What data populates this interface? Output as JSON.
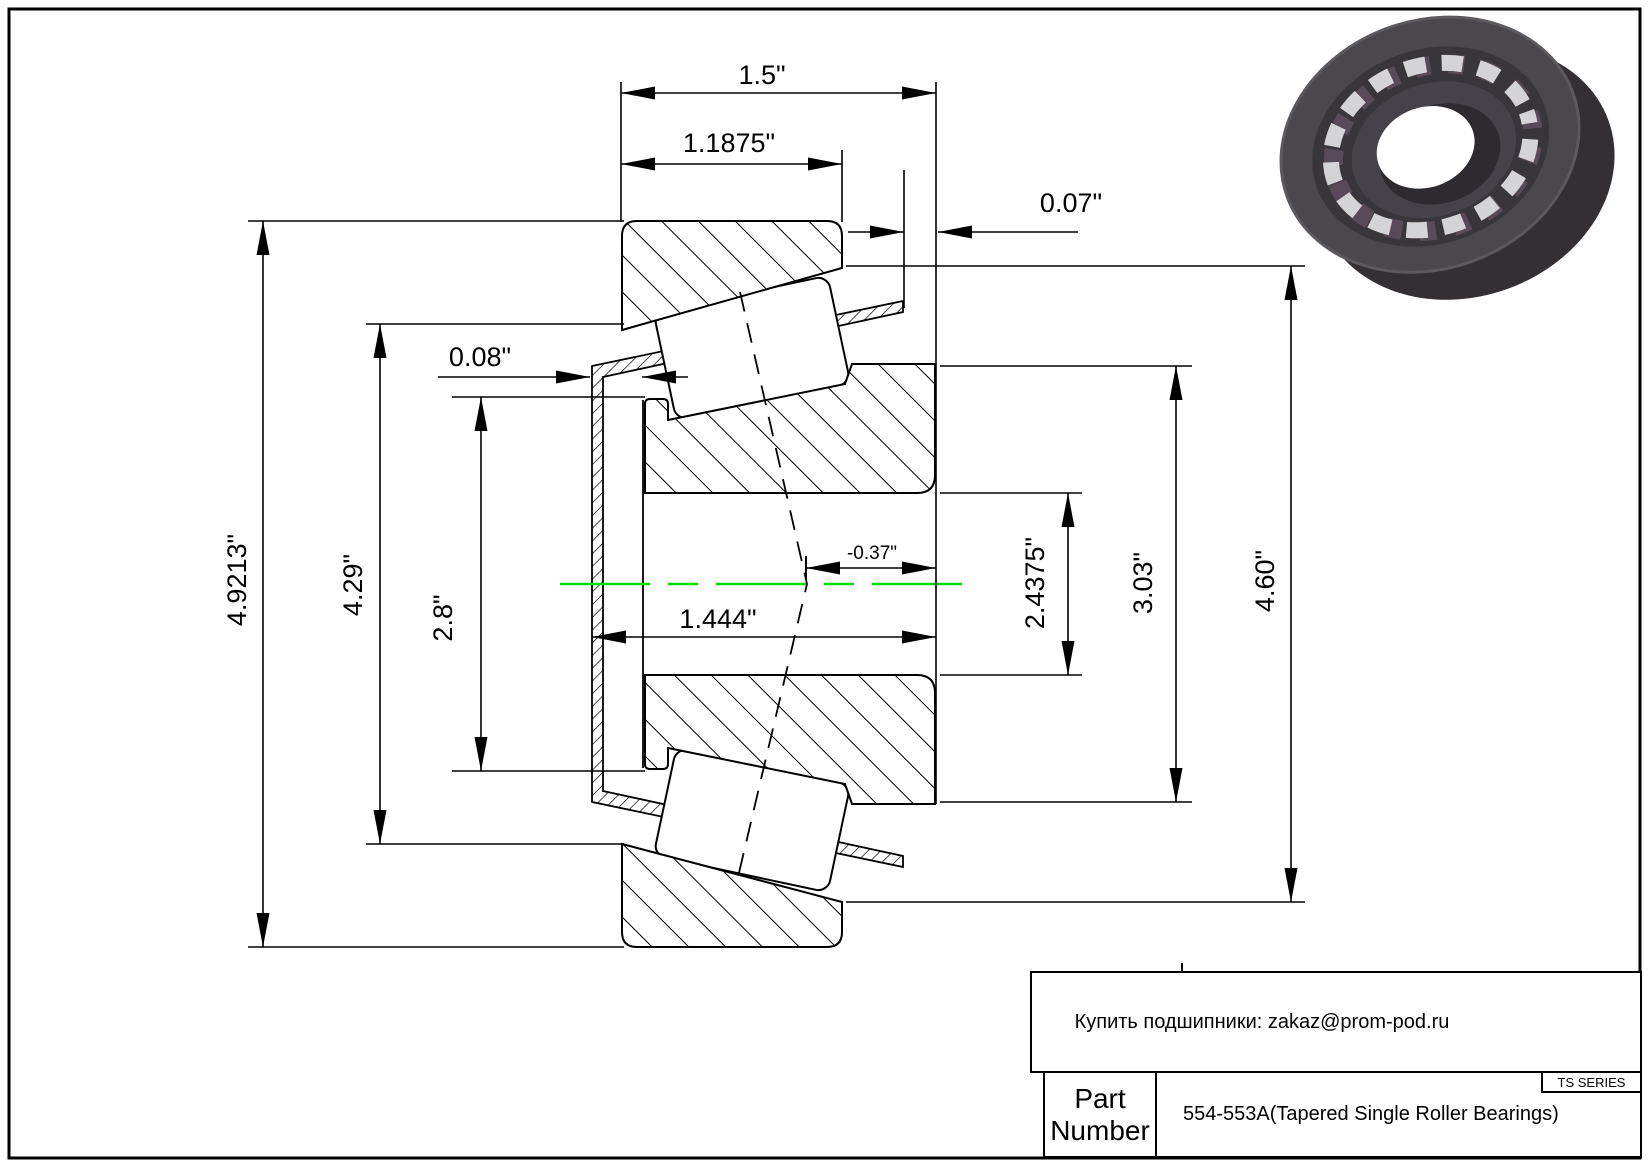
{
  "dims": {
    "overall_width": "1.5\"",
    "cup_width": "1.1875\"",
    "right_standout": "0.07\"",
    "left_standout": "0.08\"",
    "effective_center": "-0.37\"",
    "cone_width": "1.444\"",
    "outer_diameter": "4.9213\"",
    "flange_diameter": "4.29\"",
    "rib_diameter": "2.8\"",
    "bore_diameter": "2.4375\"",
    "cone_back_diameter": "3.03\"",
    "cup_face_diameter": "4.60\""
  },
  "colors": {
    "line": "#000000",
    "centerline": "#00dd00",
    "bearing_dark": "#3a373c",
    "bearing_face": "#4a474d",
    "bearing_inner": "#39363b",
    "bearing_rollers": "#d4d4d6",
    "bearing_gap": "#584a58",
    "bearing_bore": "#2e2b30"
  },
  "title_block": {
    "vendor_note": "Купить подшипники: zakaz@prom-pod.ru",
    "series_label": "TS SERIES",
    "part_label_line1": "Part",
    "part_label_line2": "Number",
    "part_number": "554-553A(Tapered Single Roller Bearings)"
  }
}
